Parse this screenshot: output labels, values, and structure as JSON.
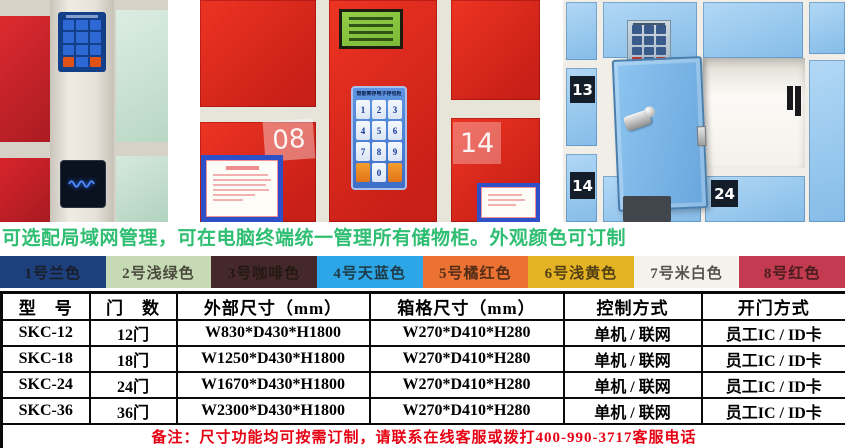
{
  "headline": {
    "text": "可选配局域网管理，可在电脑终端统一管理所有储物柜。外观颜色可订制",
    "color": "#2fbe72"
  },
  "color_options": [
    {
      "label": "1号兰色",
      "color": "#1d3f7c"
    },
    {
      "label": "2号浅绿色",
      "color": "#c7dab6"
    },
    {
      "label": "3号咖啡色",
      "color": "#45292a"
    },
    {
      "label": "4号天蓝色",
      "color": "#2ca6e6"
    },
    {
      "label": "5号橘红色",
      "color": "#eb7233"
    },
    {
      "label": "6号浅黄色",
      "color": "#e4b424"
    },
    {
      "label": "7号米白色",
      "color": "#f4f2ec"
    },
    {
      "label": "8号红色",
      "color": "#c43a51"
    }
  ],
  "spec_table": {
    "headers": [
      "型　号",
      "门　数",
      "外部尺寸（mm）",
      "箱格尺寸（mm）",
      "控制方式",
      "开门方式"
    ],
    "rows": [
      [
        "SKC-12",
        "12门",
        "W830*D430*H1800",
        "W270*D410*H280",
        "单机 / 联网",
        "员工IC / ID卡"
      ],
      [
        "SKC-18",
        "18门",
        "W1250*D430*H1800",
        "W270*D410*H280",
        "单机 / 联网",
        "员工IC / ID卡"
      ],
      [
        "SKC-24",
        "24门",
        "W1670*D430*H1800",
        "W270*D410*H280",
        "单机 / 联网",
        "员工IC / ID卡"
      ],
      [
        "SKC-36",
        "36门",
        "W2300*D430*H1800",
        "W270*D410*H280",
        "单机 / 联网",
        "员工IC / ID卡"
      ]
    ],
    "note": "备注：尺寸功能均可按需订制，请联系在线客服或拨打400-990-3717客服电话",
    "note_color": "#e60012"
  },
  "photos": {
    "middle": {
      "door_numbers": [
        "08",
        "14"
      ],
      "keypad": {
        "title": "智能寄存电子存包柜",
        "digits": [
          "1",
          "2",
          "3",
          "4",
          "5",
          "6",
          "7",
          "8",
          "9",
          "0"
        ]
      }
    },
    "right": {
      "door_numbers": [
        "13",
        "14",
        "24"
      ]
    }
  }
}
